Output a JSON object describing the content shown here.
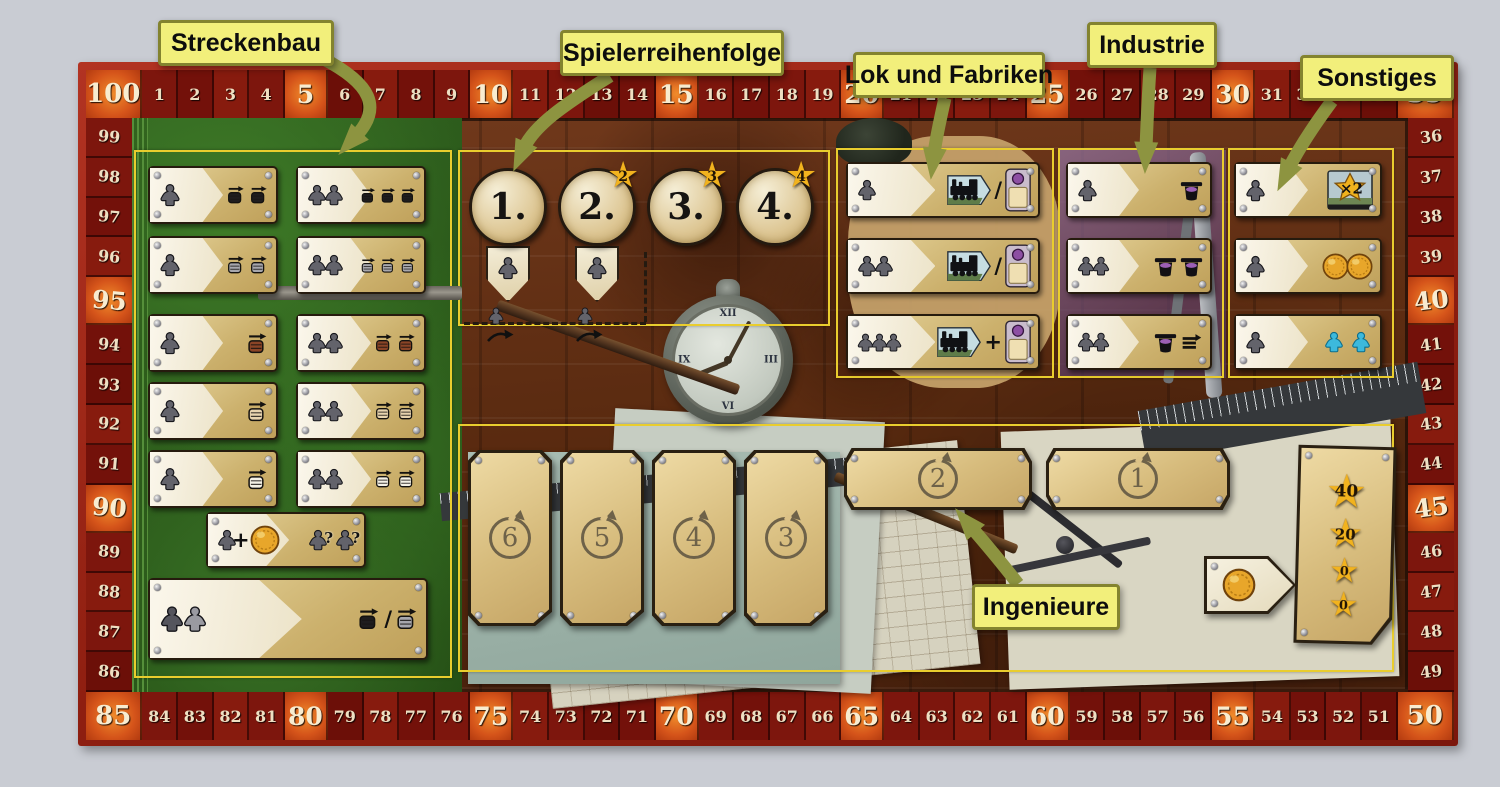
{
  "colors": {
    "accent_yellow": "#f2ef7b",
    "frame_red": "#8e1e10",
    "highlight_orange": "#e0661c",
    "wood_brown": "#56280e",
    "leaf_green": "#2d5c1d",
    "plate_tan": "#d7bc7d",
    "gold": "#f2b31e",
    "teal": "#3cb9dc",
    "purple": "#8d4fa3"
  },
  "callouts": [
    {
      "id": "streckenbau",
      "text": "Streckenbau"
    },
    {
      "id": "spielerreihenfolge",
      "text": "Spielerreihenfolge"
    },
    {
      "id": "lok-und-fabriken",
      "text": "Lok und Fabriken"
    },
    {
      "id": "industrie",
      "text": "Industrie"
    },
    {
      "id": "sonstiges",
      "text": "Sonstiges"
    },
    {
      "id": "ingenieure",
      "text": "Ingenieure"
    }
  ],
  "score_track": {
    "top": [
      "100",
      "1",
      "2",
      "3",
      "4",
      "5",
      "6",
      "7",
      "8",
      "9",
      "10",
      "11",
      "12",
      "13",
      "14",
      "15",
      "16",
      "17",
      "18",
      "19",
      "20",
      "21",
      "22",
      "23",
      "24",
      "25",
      "26",
      "27",
      "28",
      "29",
      "30",
      "31",
      "32",
      "33",
      "34",
      "35"
    ],
    "right": [
      "36",
      "37",
      "38",
      "39",
      "40",
      "41",
      "42",
      "43",
      "44",
      "45",
      "46",
      "47",
      "48",
      "49"
    ],
    "bottom": [
      "85",
      "84",
      "83",
      "82",
      "81",
      "80",
      "79",
      "78",
      "77",
      "76",
      "75",
      "74",
      "73",
      "72",
      "71",
      "70",
      "69",
      "68",
      "67",
      "66",
      "65",
      "64",
      "63",
      "62",
      "61",
      "60",
      "59",
      "58",
      "57",
      "56",
      "55",
      "54",
      "53",
      "52",
      "51",
      "50"
    ],
    "left": [
      "99",
      "98",
      "97",
      "96",
      "95",
      "94",
      "93",
      "92",
      "91",
      "90",
      "89",
      "88",
      "87",
      "86"
    ],
    "corners": [
      "100",
      "35",
      "50",
      "85"
    ]
  },
  "streckenbau": {
    "rows": [
      {
        "color": "black",
        "left": {
          "workers": 1,
          "rails": 2
        },
        "right": {
          "workers": 2,
          "rails": 3
        }
      },
      {
        "color": "grey",
        "left": {
          "workers": 1,
          "rails": 2
        },
        "right": {
          "workers": 2,
          "rails": 3
        }
      },
      {
        "color": "brown",
        "left": {
          "workers": 1,
          "rails": 1
        },
        "right": {
          "workers": 2,
          "rails": 2
        }
      },
      {
        "color": "beige",
        "left": {
          "workers": 1,
          "rails": 1
        },
        "right": {
          "workers": 2,
          "rails": 2
        }
      },
      {
        "color": "white",
        "left": {
          "workers": 1,
          "rails": 1
        },
        "right": {
          "workers": 2,
          "rails": 2
        }
      }
    ],
    "coin_card": {
      "workers": 1,
      "plus": "+",
      "question": "?",
      "result_workers": 2
    },
    "wide_card": {
      "workers": 2,
      "slash": "/",
      "rail_colors": [
        "black",
        "grey"
      ]
    }
  },
  "player_order": {
    "positions": [
      {
        "label": "1.",
        "star": "",
        "worker_slot": true
      },
      {
        "label": "2.",
        "star": "2",
        "worker_slot": true
      },
      {
        "label": "3.",
        "star": "3",
        "worker_slot": false
      },
      {
        "label": "4.",
        "star": "4",
        "worker_slot": false
      }
    ]
  },
  "lok_und_fabriken": {
    "rows": [
      {
        "workers": 1,
        "separator": "/"
      },
      {
        "workers": 2,
        "separator": "/"
      },
      {
        "workers": 3,
        "separator": "+"
      }
    ]
  },
  "industrie": {
    "rows": [
      {
        "workers": 1,
        "markers": 1,
        "extra_rail": false
      },
      {
        "workers": 2,
        "markers": 2,
        "extra_rail": false
      },
      {
        "workers": 2,
        "markers": 1,
        "extra_rail": true
      }
    ]
  },
  "sonstiges": {
    "rows": [
      {
        "workers": 1,
        "reward": "double_tile",
        "tile_label": "×2"
      },
      {
        "workers": 1,
        "reward": "coins",
        "coins": 2
      },
      {
        "workers": 1,
        "reward": "extra_workers",
        "extra_workers": 2
      }
    ]
  },
  "ingenieure": {
    "tall_plates": [
      "6",
      "5",
      "4",
      "3"
    ],
    "wide_plates": [
      "2",
      "1"
    ],
    "star_values": [
      "40",
      "20",
      "0",
      "0"
    ],
    "coin_plate": true
  },
  "decor": {
    "clock_numerals": [
      "XII",
      "III",
      "VI",
      "IX"
    ]
  }
}
